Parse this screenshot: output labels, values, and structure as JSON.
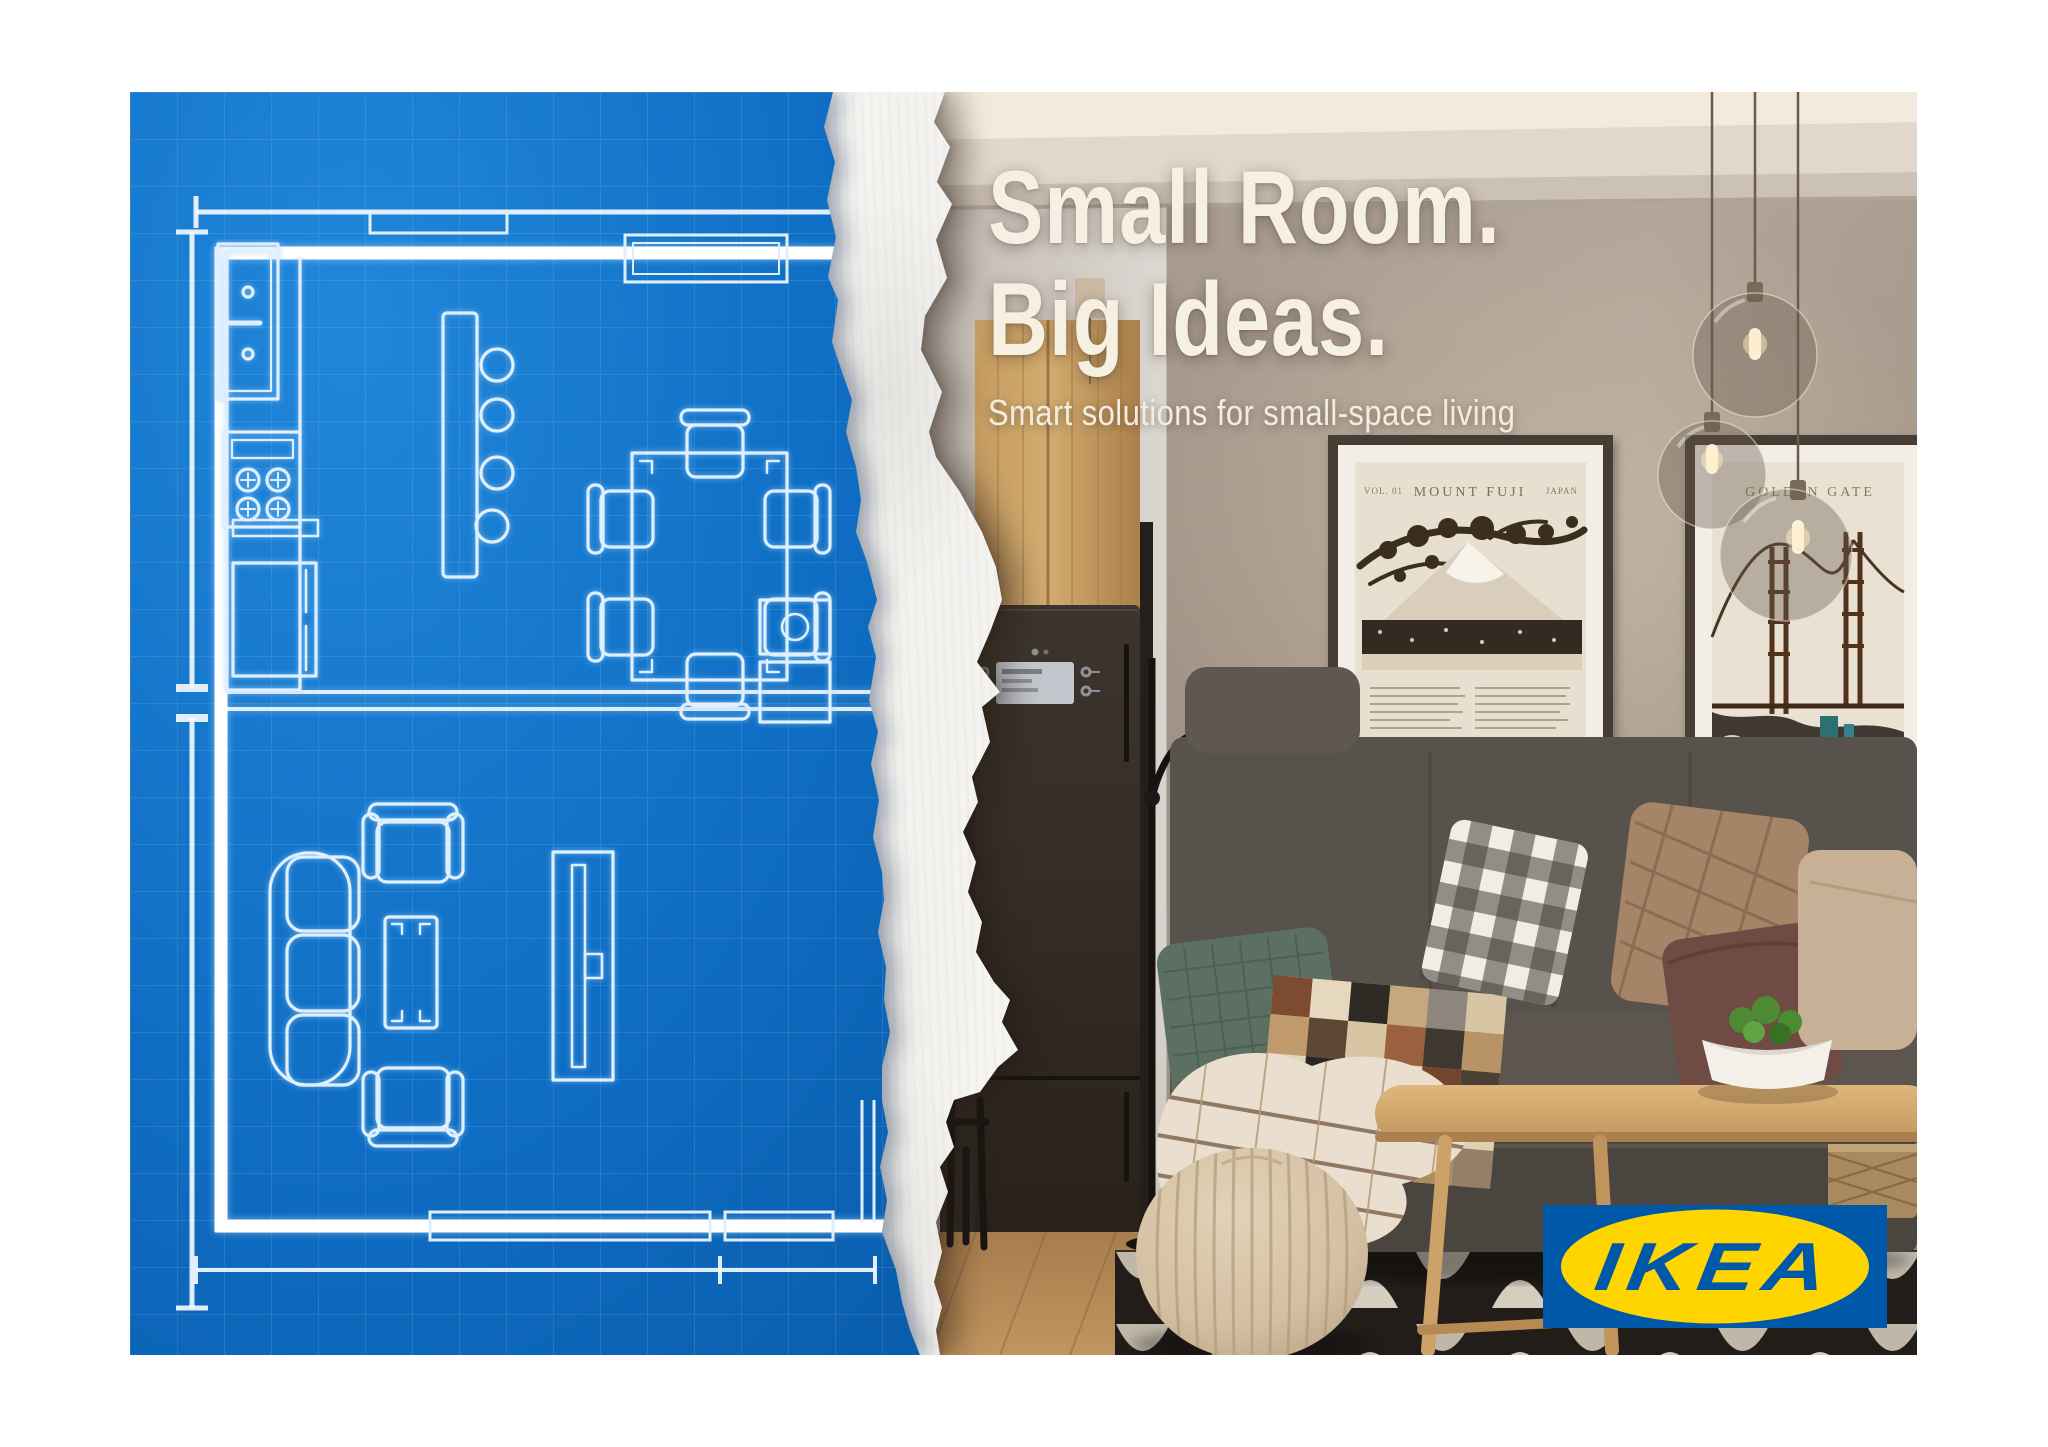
{
  "poster": {
    "headline_line1": "Small Room.",
    "headline_line2": "Big Ideas.",
    "subtitle": "Smart solutions for small-space living",
    "headline_color": "#F6F0E2"
  },
  "brand": {
    "name": "IKEA",
    "logo_text": "IKEA",
    "logo_blue": "#0058A8",
    "logo_yellow": "#FFD500"
  },
  "blueprint": {
    "background_color": "#0F6FC5",
    "grid_color": "#4D9BE0",
    "line_color": "#E8F3FD",
    "wall_color": "#FFFFFF"
  },
  "wall_art": {
    "poster_fuji": {
      "kicker_left": "VOL. 01",
      "title": "MOUNT FUJI",
      "kicker_right": "JAPAN"
    },
    "poster_golden_gate": {
      "title": "GOLDEN GATE"
    }
  }
}
